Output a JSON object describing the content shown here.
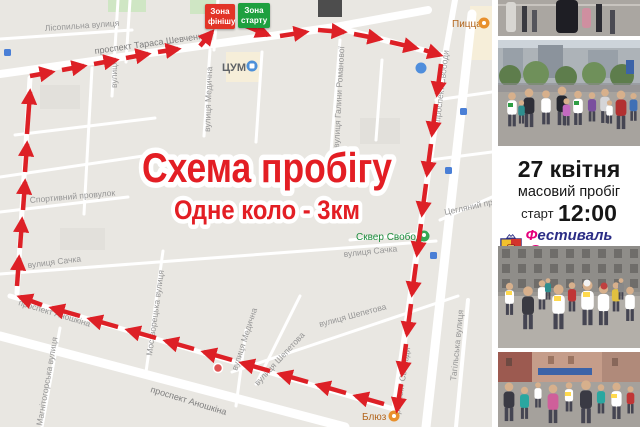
{
  "map": {
    "title": "Схема пробігу",
    "subtitle": "Одне коло - 3км",
    "badges": {
      "finish_line1": "Зона",
      "finish_line2": "фінішу",
      "start_line1": "Зона",
      "start_line2": "старту"
    },
    "streets": {
      "shevchenka": "проспект Тараса Шевченка",
      "lisopylna": "Лісопильна вулиця",
      "vert_top": "вулиця",
      "medychna_top": "вулиця Медична",
      "romanova": "вулиця Галини Романової",
      "sportyvnyi": "Спортивний провулок",
      "sachka_left": "вулиця Сачка",
      "sachka_right": "вулиця Сачка",
      "moskvoretska": "Москворецька вулиця",
      "anoshkina_route": "проспект Аношкіна",
      "anoshkina_wide": "проспект Аношкіна",
      "mahnitohorska": "Магнітогорська вулиця",
      "medychna_bottom": "вулиця Медична",
      "shepetova_1": "вулиця Шепетова",
      "shepetova_2": "вулиця Шепетова",
      "svobody_1": "проспект Свободи",
      "svobody_2": "проспект Свободи",
      "tahilska": "Тагільська вулиця",
      "tsehlianyi": "Цегляний провулок"
    },
    "pois": {
      "tsum": "ЦУМ",
      "pizza": "Пицца",
      "skver": "Сквер Свободи",
      "bluz": "Блюз"
    },
    "icons": [
      "shopping-poi-icon",
      "food-poi-icon",
      "park-poi-icon",
      "transit-stop-icon",
      "route-arrow-icon"
    ]
  },
  "panel": {
    "date": "27 квітня",
    "event": "масовий пробіг",
    "start_label": "старт",
    "start_time": "12:00",
    "logo": {
      "line1_initial": "Ф",
      "line1_rest": "естиваль",
      "line2_initial": "С",
      "line2_rest": "порту"
    }
  },
  "colors": {
    "route_red": "#dd2026",
    "title_red": "#e31e24",
    "finish_badge": "#e23427",
    "start_badge": "#1ea03f",
    "logo_blue": "#2b2d86",
    "logo_pink": "#e5007d",
    "map_background": "#e9e7e2"
  }
}
